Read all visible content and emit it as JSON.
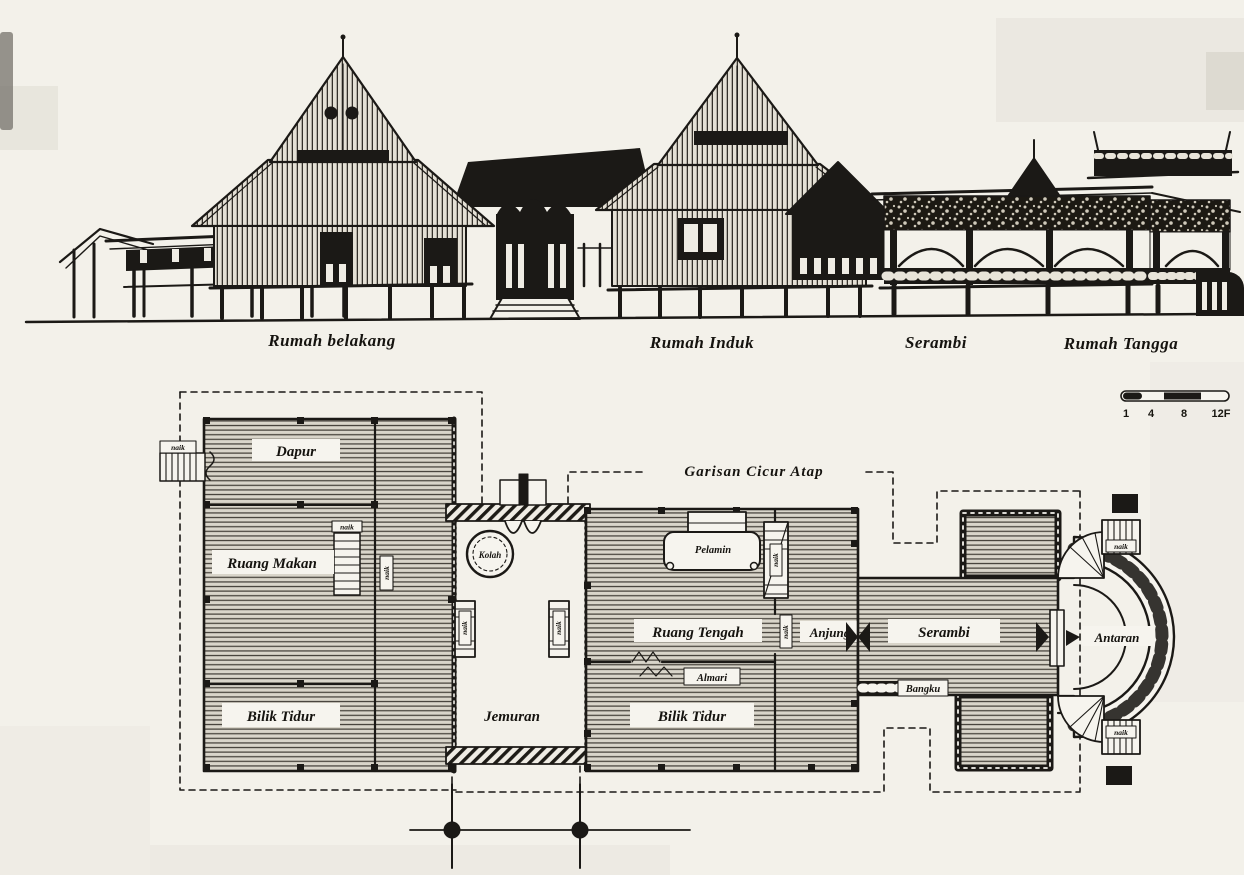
{
  "elevation": {
    "labels": {
      "rumah_belakang": "Rumah belakang",
      "rumah_induk": "Rumah Induk",
      "serambi": "Serambi",
      "rumah_tangga": "Rumah Tangga"
    }
  },
  "plan": {
    "eaves_line_label": "Garisan Cicur Atap",
    "stair_label": "naik",
    "rooms": {
      "dapur": "Dapur",
      "ruang_makan": "Ruang Makan",
      "bilik_tidur_left": "Bilik Tidur",
      "jemuran": "Jemuran",
      "kolah": "Kolah",
      "pelamin": "Pelamin",
      "ruang_tengah": "Ruang Tengah",
      "anjung": "Anjung",
      "almari": "Almari",
      "bilik_tidur_right": "Bilik Tidur",
      "serambi": "Serambi",
      "bangku": "Bangku",
      "antaran": "Antaran"
    }
  },
  "scale_bar": {
    "ticks": [
      "1",
      "4",
      "8",
      "12F"
    ]
  }
}
